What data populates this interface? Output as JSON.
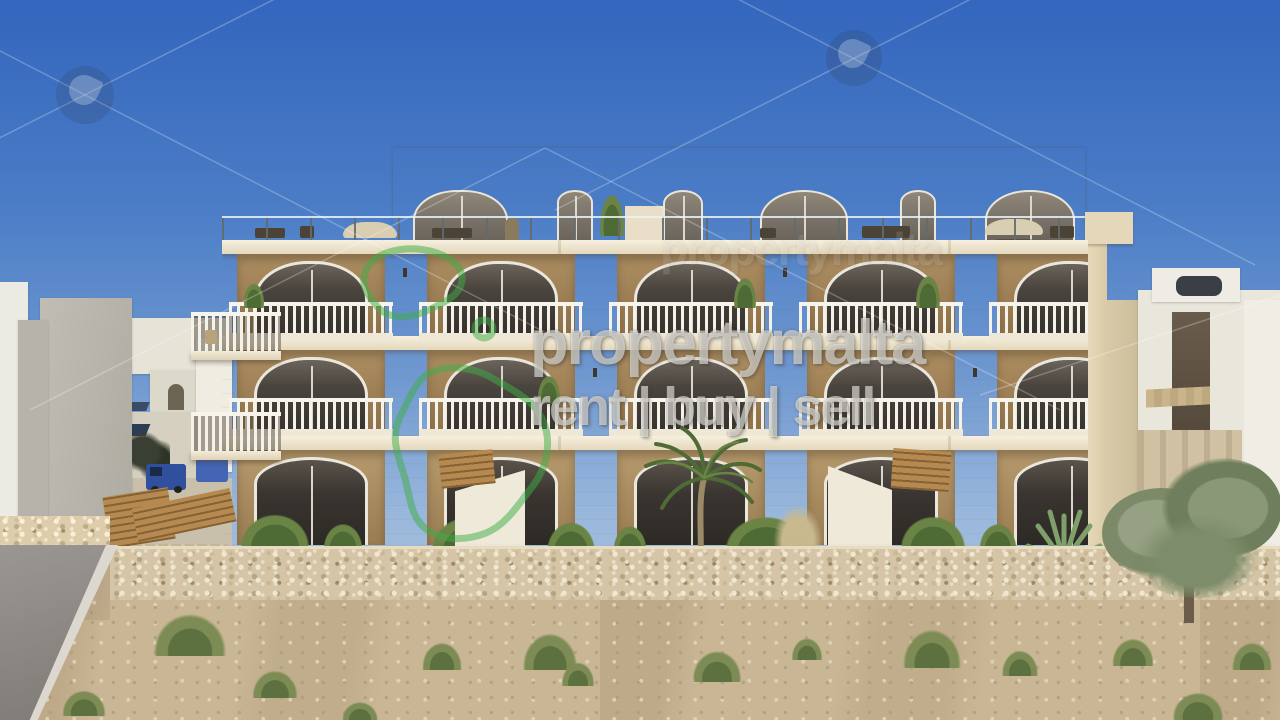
{
  "watermark": {
    "brand": "propertymalta",
    "tagline": "rent | buy | sell",
    "logo_name": "malta-islands-outline-logo",
    "logo_color": "#3fae46",
    "text_color": "rgba(252,252,250,0.55)"
  },
  "scene": {
    "type": "3d-architectural-render",
    "subject": "four-storey Maltese limestone apartment block with arched windows, recessed balconies and white balustrades",
    "foreground": "rubble stone boundary wall, dirt field with grass tufts, road at lower left",
    "background": "blue sky, white town buildings left and right, olive tree lower right",
    "colors": {
      "sky_top": "#3366bd",
      "sky_horizon": "#bccfe3",
      "limestone": "#e3d5b5",
      "balcony_recess": "#9a7c52",
      "window_glass": "#3a3530",
      "balustrade_white": "#f5f2e9",
      "rubble_wall": "#d5c5a6",
      "ground_dirt": "#c9b694",
      "vegetation_green": "#5d7040"
    }
  }
}
